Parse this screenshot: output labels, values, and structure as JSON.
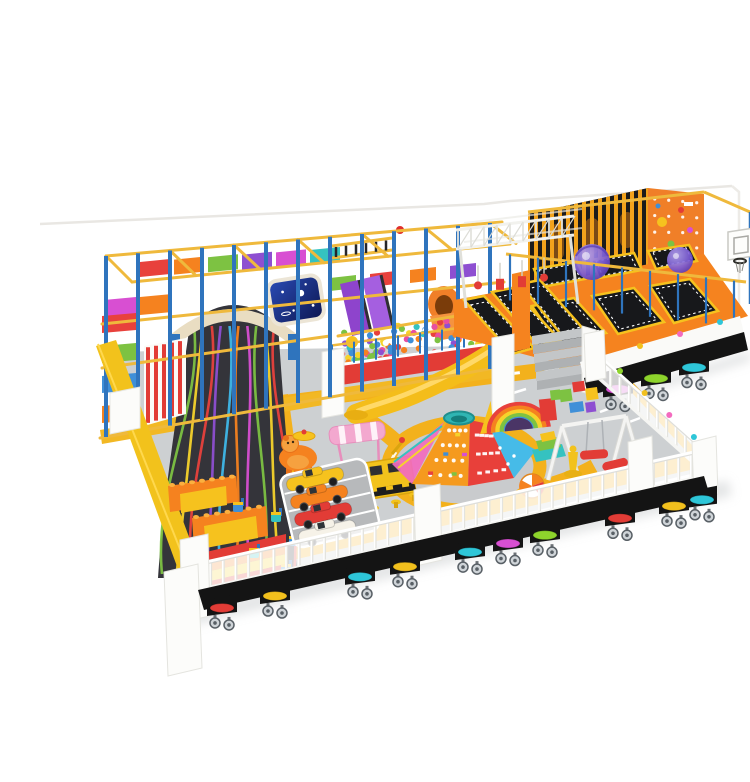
{
  "scene": {
    "subject": "indoor-soft-play-playground-equipment-render",
    "background": "#ffffff"
  },
  "palette": {
    "frame_rail": "#efb93c",
    "frame_post": "#2f74bd",
    "slide_body": "#34343a",
    "slide_arch": "#e9ddc2",
    "floor": "#cdd0d2",
    "road": "#f3b11c",
    "road_line": "#ffffff",
    "deck": "#f5831f",
    "bed": "#17181b",
    "pad": "#f6c21e",
    "wall_black": "#1b1b1b",
    "wall_stripe": "#f2a21c",
    "climb_panel": "#f07f28",
    "fence": "#fafaf8",
    "base": "#141414",
    "wheel": "#cfd4d8",
    "left_wall": "#f2c21c",
    "red": "#e23c36",
    "orange": "#f5821f",
    "yellow": "#f6c21e",
    "green": "#7dc242",
    "blue": "#3f8fd8",
    "purple": "#8e4fd1",
    "magenta": "#d84fd2",
    "pink": "#f3a8cf",
    "teal": "#35c2c0",
    "white": "#ffffff",
    "ball_purple": "#7b5bd6",
    "screen_blue": "#1c337e"
  },
  "structure": {
    "pad_colors_row1": [
      "#e8413c",
      "#f5821f",
      "#7dc242",
      "#8e4fd1",
      "#d84fd2",
      "#35c2c0"
    ],
    "pad_colors_row2": [
      "#d84fd2",
      "#f5821f"
    ],
    "pad_colors_mid": [
      "#7dc242",
      "#e8413c",
      "#f5821f",
      "#8e4fd1"
    ],
    "pad_colors_left": [
      "#e8413c",
      "#7dc242",
      "#3f8fd8",
      "#f5821f"
    ],
    "slide_stripes": [
      "#7dc242",
      "#f6d32b",
      "#e8413c",
      "#8e4fd1",
      "#3fb7e8",
      "#f5821f",
      "#d84fd2",
      "#7dc242",
      "#f6d32b",
      "#e8413c"
    ],
    "stair_colors": [
      "#e8413c",
      "#f5821f",
      "#f6d32b",
      "#7dc242",
      "#3f8fd8",
      "#8e4fd1"
    ]
  },
  "ball_pit": {
    "colors": [
      "#e8413c",
      "#f6d32b",
      "#7dc242",
      "#3f8fd8",
      "#8e4fd1",
      "#f5821f",
      "#e84fa0",
      "#35c2c0",
      "#ffffff"
    ]
  },
  "counts": {
    "trampoline_beds": 9,
    "wrecking_balls": 2,
    "toy_cars": 4,
    "caster_stools": 13
  },
  "toddler": {
    "car_colors": [
      "#f6c21e",
      "#f5821f",
      "#e23c36",
      "#f6f2e8"
    ],
    "arch_colors": [
      "#e8413c",
      "#f5821f",
      "#f6d32b",
      "#7dc242",
      "#3f8fd8",
      "#8e4fd1"
    ],
    "stripe_colors": [
      "#e23c36",
      "#f5821f",
      "#f6d32b",
      "#e23c36"
    ],
    "hold_colors": [
      "#e8413c",
      "#3f8fd8",
      "#f6d32b",
      "#7dc242",
      "#d84fd2"
    ]
  },
  "fence": {
    "front_stools": [
      "#e23c36",
      "#f2c01d",
      "#2ec6d8",
      "#f2c01d",
      "#2ec6d8",
      "#d84fd2",
      "#8ed42c",
      "#e23c36",
      "#f2c01d",
      "#2ec6d8"
    ],
    "upper_stools": [
      "#d84fd2",
      "#8ed42c",
      "#2ec6d8"
    ],
    "rail_markers": [
      "#8ed42c",
      "#f2c01d",
      "#f36bbf",
      "#2ec6d8"
    ]
  }
}
